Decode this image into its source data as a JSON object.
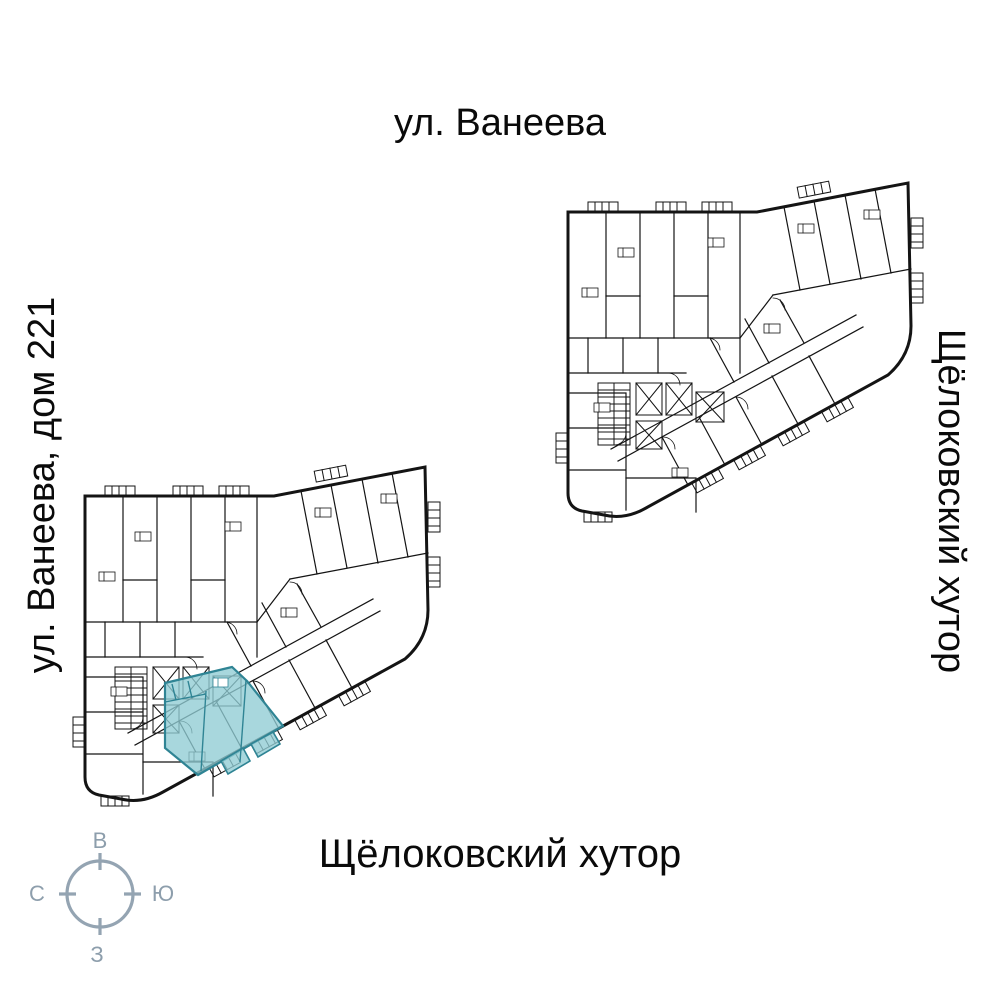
{
  "labels": {
    "street_top": "ул. Ванеева",
    "street_left": "ул. Ванеева, дом 221",
    "street_right": "Щёлоковский хутор",
    "street_bottom": "Щёлоковский хутор"
  },
  "compass": {
    "top": "В",
    "right": "Ю",
    "bottom": "З",
    "left": "С"
  },
  "colors": {
    "background": "#ffffff",
    "plan_lines": "#141414",
    "highlight_fill": "#8fccd4",
    "highlight_stroke": "#2f8494",
    "compass": "#94a4b2",
    "label_text": "#0a0a0a"
  }
}
